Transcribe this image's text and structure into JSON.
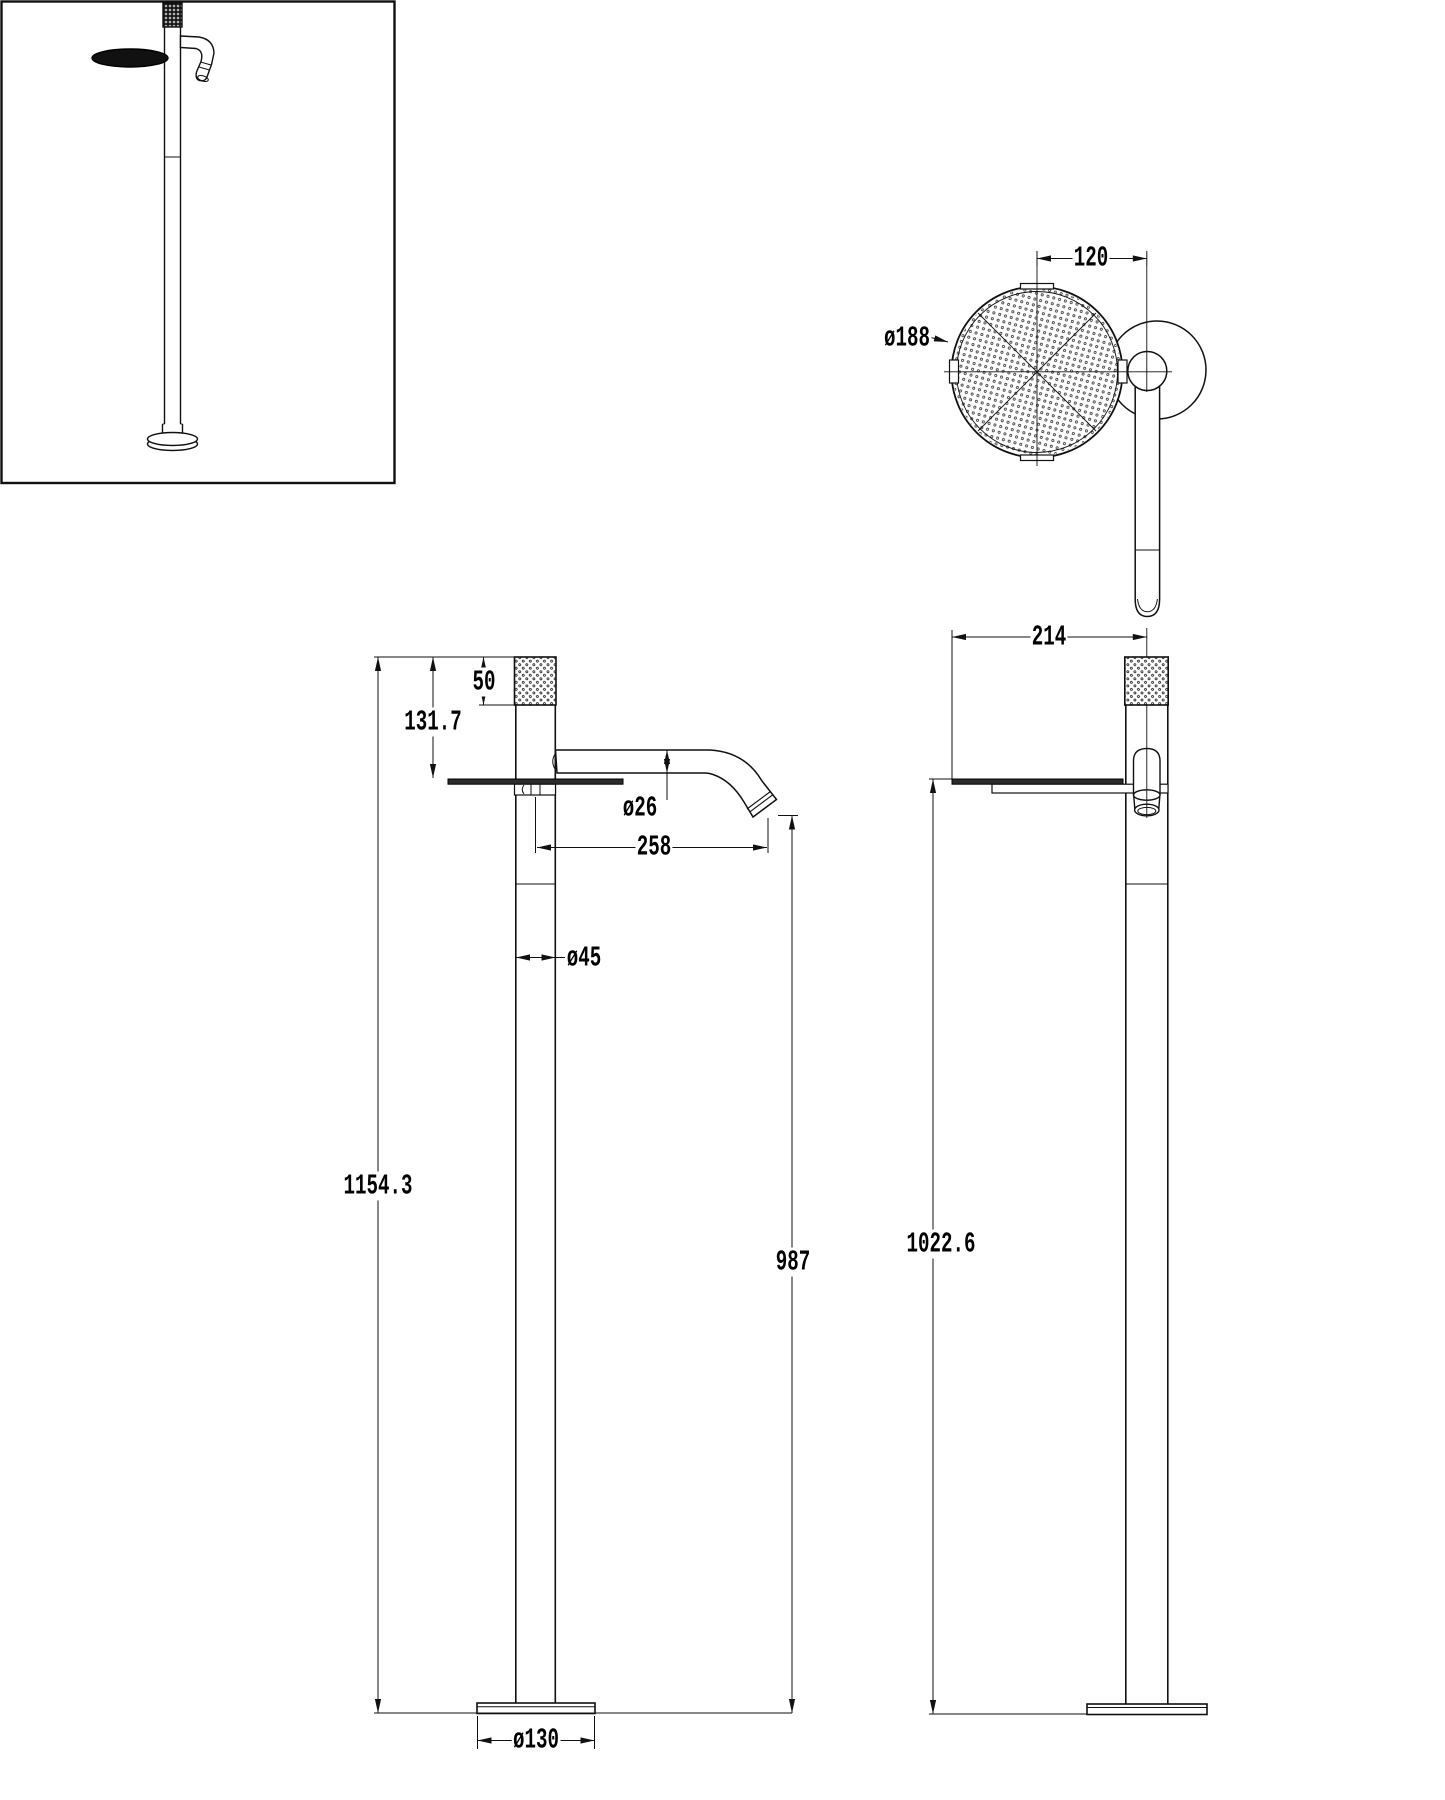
{
  "drawing": {
    "background": "#ffffff",
    "line_color": "#111111",
    "tray_fill": "#2b2b2b",
    "views": {
      "top": {
        "head_diameter": "ø188",
        "head_offset": "120"
      },
      "front": {
        "cap_height": "50",
        "cap_to_tray": "131.7",
        "spout_diameter": "ø26",
        "spout_reach": "258",
        "column_diameter": "ø45",
        "overall_height": "1154.3",
        "spout_outlet_height": "987",
        "base_diameter": "ø130"
      },
      "side": {
        "overall_depth": "214",
        "tray_surface_height": "1022.6"
      }
    }
  }
}
